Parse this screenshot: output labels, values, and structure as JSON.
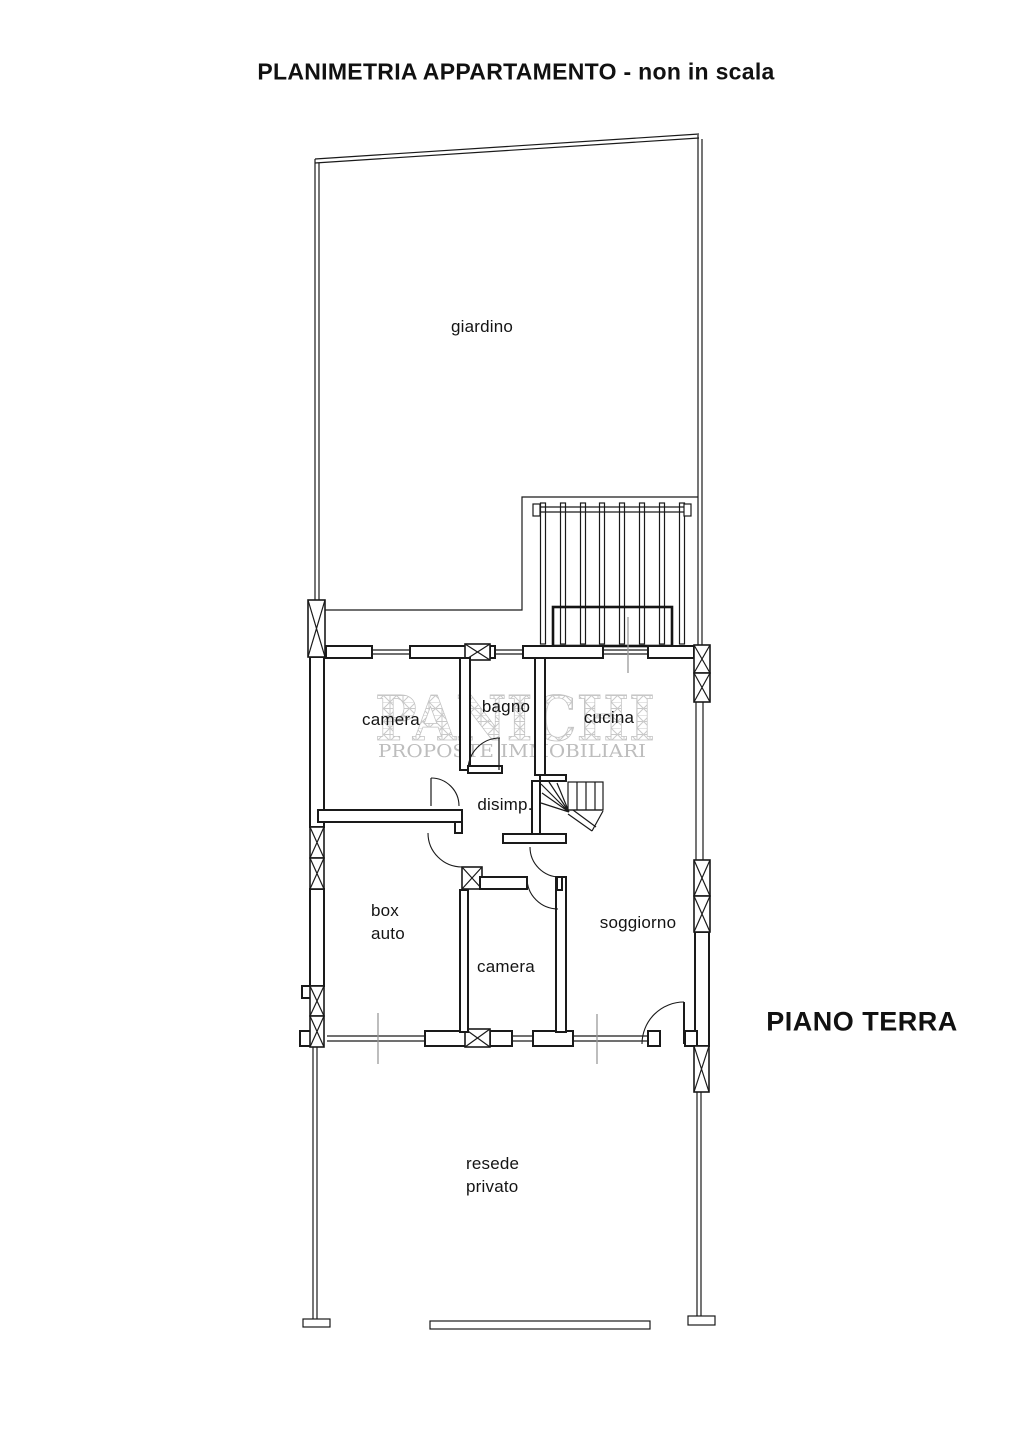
{
  "page": {
    "title": "PLANIMETRIA APPARTAMENTO - non in scala",
    "floor_label": "PIANO TERRA"
  },
  "watermark": {
    "name": "PANICHI",
    "tagline": "PROPOSTE IMMOBILIARI"
  },
  "areas": {
    "garden": "giardino",
    "bedroom_top": "camera",
    "bathroom": "bagno",
    "kitchen": "cucina",
    "hallway": "disimp.",
    "garage_line1": "box",
    "garage_line2": "auto",
    "bedroom_bottom": "camera",
    "living_room": "soggiorno",
    "yard_line1": "resede",
    "yard_line2": "privato"
  },
  "colors": {
    "line": "#1a1a1a",
    "dimension_tick": "#9a9a9a",
    "watermark_hatch": "#c9c9c9",
    "watermark_text": "#bdbdbd"
  }
}
